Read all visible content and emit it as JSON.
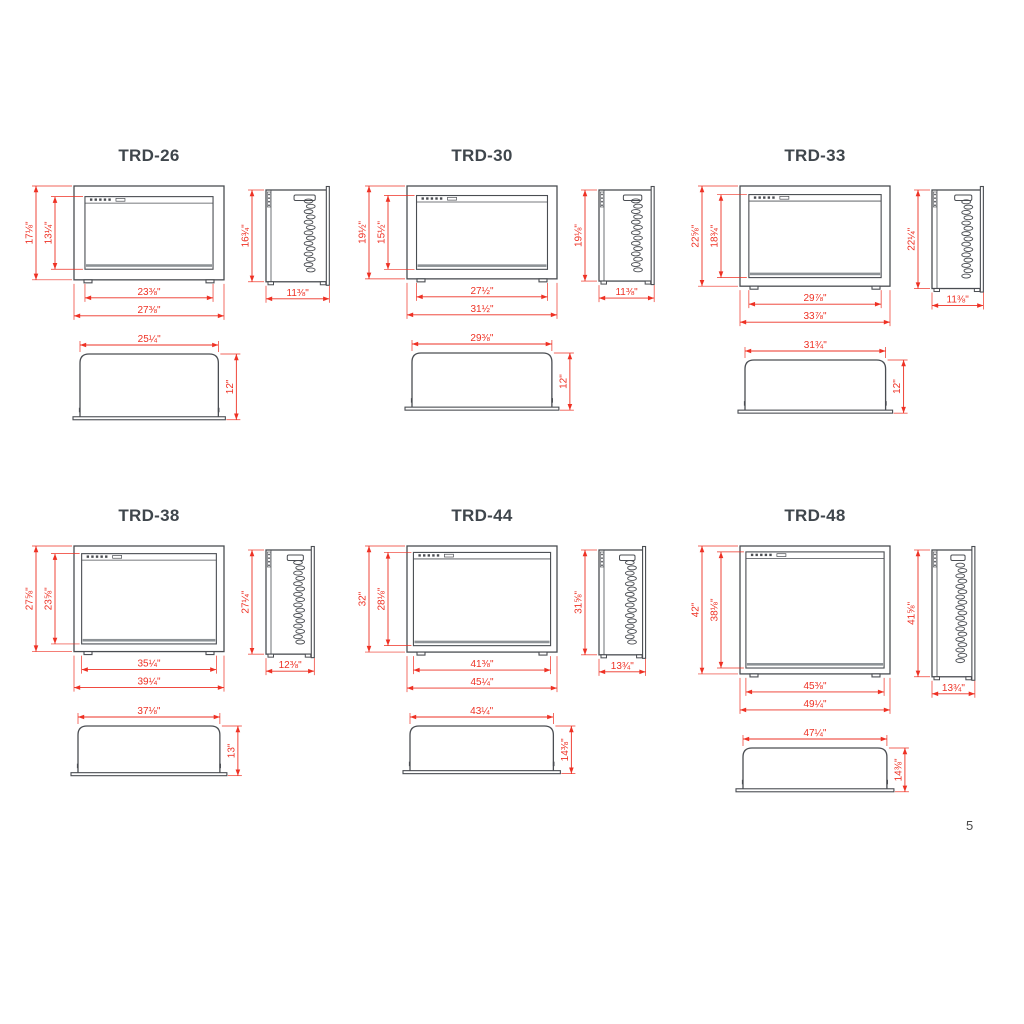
{
  "page_number": "5",
  "colors": {
    "line": "#4a4d52",
    "dim": "#ee3124",
    "title": "#3f464c"
  },
  "models": [
    {
      "name": "TRD-26",
      "front": {
        "outer_w_in": 27.375,
        "outer_h_in": 17.125,
        "inner_w_in": 23.375,
        "inner_h_in": 13.25,
        "outer_w": "27⅜\"",
        "outer_h": "17⅛\"",
        "inner_w": "23⅜\"",
        "inner_h": "13¼\""
      },
      "side": {
        "h_in": 16.75,
        "d_in": 11.375,
        "h": "16¾\"",
        "d": "11⅜\""
      },
      "top": {
        "w_in": 25.25,
        "d_in": 12,
        "w": "25¼\"",
        "d": "12\""
      }
    },
    {
      "name": "TRD-30",
      "front": {
        "outer_w_in": 31.5,
        "outer_h_in": 19.5,
        "inner_w_in": 27.5,
        "inner_h_in": 15.5,
        "outer_w": "31½\"",
        "outer_h": "19½\"",
        "inner_w": "27½\"",
        "inner_h": "15½\""
      },
      "side": {
        "h_in": 19.125,
        "d_in": 11.375,
        "h": "19⅛\"",
        "d": "11⅜\""
      },
      "top": {
        "w_in": 29.375,
        "d_in": 12,
        "w": "29⅜\"",
        "d": "12\""
      }
    },
    {
      "name": "TRD-33",
      "front": {
        "outer_w_in": 33.875,
        "outer_h_in": 22.625,
        "inner_w_in": 29.875,
        "inner_h_in": 18.75,
        "outer_w": "33⅞\"",
        "outer_h": "22⅝\"",
        "inner_w": "29⅞\"",
        "inner_h": "18¾\""
      },
      "side": {
        "h_in": 22.25,
        "d_in": 11.375,
        "h": "22¼\"",
        "d": "11⅜\""
      },
      "top": {
        "w_in": 31.75,
        "d_in": 12,
        "w": "31¾\"",
        "d": "12\""
      }
    },
    {
      "name": "TRD-38",
      "front": {
        "outer_w_in": 39.25,
        "outer_h_in": 27.625,
        "inner_w_in": 35.25,
        "inner_h_in": 23.625,
        "outer_w": "39¼\"",
        "outer_h": "27⅝\"",
        "inner_w": "35¼\"",
        "inner_h": "23⅝\""
      },
      "side": {
        "h_in": 27.25,
        "d_in": 12.375,
        "h": "27¼\"",
        "d": "12⅜\""
      },
      "top": {
        "w_in": 37.125,
        "d_in": 13,
        "w": "37⅛\"",
        "d": "13\""
      }
    },
    {
      "name": "TRD-44",
      "front": {
        "outer_w_in": 45.25,
        "outer_h_in": 32,
        "inner_w_in": 41.375,
        "inner_h_in": 28.125,
        "outer_w": "45¼\"",
        "outer_h": "32\"",
        "inner_w": "41⅜\"",
        "inner_h": "28⅛\""
      },
      "side": {
        "h_in": 31.625,
        "d_in": 13.75,
        "h": "31⅝\"",
        "d": "13¾\""
      },
      "top": {
        "w_in": 43.25,
        "d_in": 14.375,
        "w": "43¼\"",
        "d": "14⅜\""
      }
    },
    {
      "name": "TRD-48",
      "front": {
        "outer_w_in": 49.25,
        "outer_h_in": 42,
        "inner_w_in": 45.375,
        "inner_h_in": 38.125,
        "outer_w": "49¼\"",
        "outer_h": "42\"",
        "inner_w": "45⅜\"",
        "inner_h": "38⅛\""
      },
      "side": {
        "h_in": 41.625,
        "d_in": 13.75,
        "h": "41⅝\"",
        "d": "13¾\""
      },
      "top": {
        "w_in": 47.25,
        "d_in": 14.375,
        "w": "47¼\"",
        "d": "14⅜\""
      }
    }
  ]
}
